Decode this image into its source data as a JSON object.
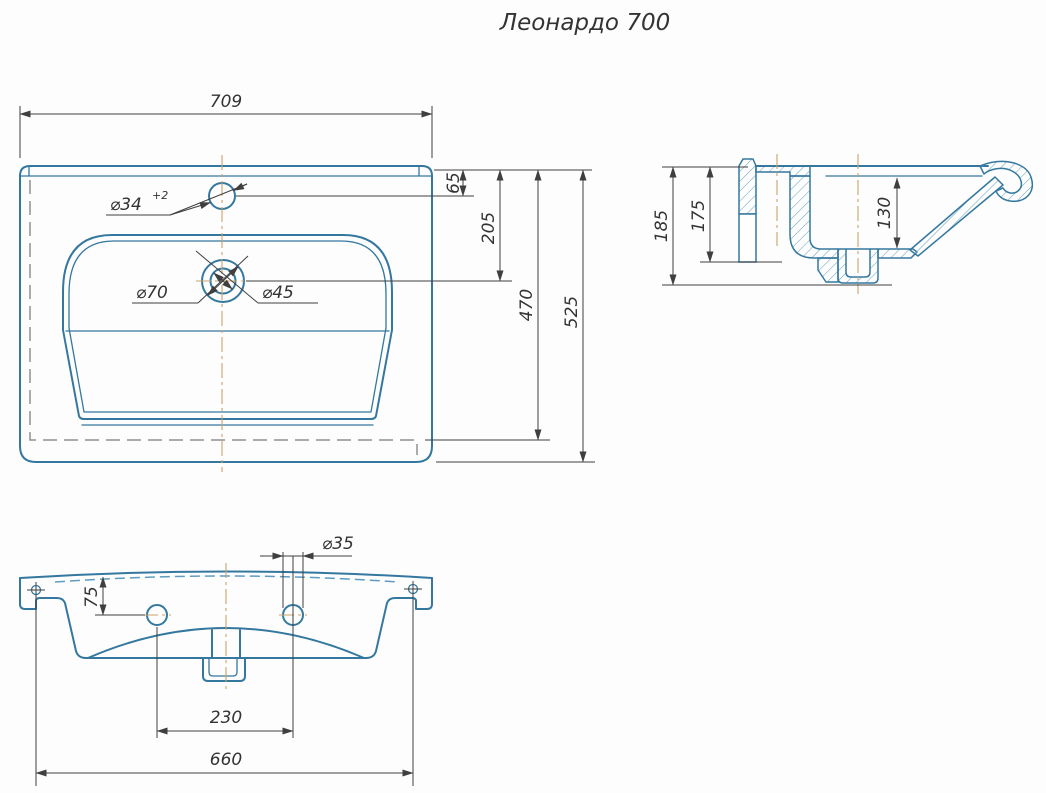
{
  "title": "Леонардо 700",
  "drawing": {
    "top_view": {
      "width": "709",
      "faucet_hole_offset": "65",
      "drain_offset": "205",
      "inner_depth": "470",
      "depth": "525",
      "faucet_hole_diameter": "⌀34",
      "faucet_hole_tolerance": "+2",
      "drain_recess_diameter": "⌀70",
      "drain_hole_diameter": "⌀45"
    },
    "side_view": {
      "total_height": "185",
      "body_height": "175",
      "basin_depth": "130"
    },
    "front_view": {
      "overflow_hole_diameter": "⌀35",
      "overflow_hole_offset": "75",
      "overflow_hole_spacing": "230",
      "mounting_hole_spacing": "660"
    }
  },
  "colors": {
    "part_line": "#34789F",
    "part_line_light": "#7FB3CC",
    "hatch_line": "#6FA6C0",
    "hidden_line": "#909090",
    "hidden_line_blue": "#5E9CC2",
    "dimension_line": "#3F3F3F",
    "text": "#333333",
    "center_line": "#C9A36B",
    "background": "#FDFDFD"
  }
}
